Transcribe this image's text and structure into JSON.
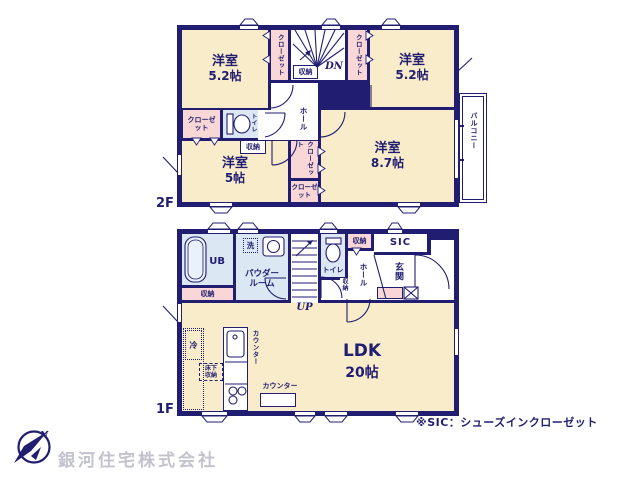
{
  "f2": {
    "label": "2F",
    "room_tl": "洋室",
    "room_tl_size": "5.2帖",
    "room_tr": "洋室",
    "room_tr_size": "5.2帖",
    "room_bl": "洋室",
    "room_bl_size": "5帖",
    "room_br": "洋室",
    "room_br_size": "8.7帖",
    "closet_left": "クローゼット",
    "closet_right": "クローゼット",
    "closet_wall": "クローゼット",
    "closet_mid": "クローゼット",
    "closet_mid2": "クローゼット",
    "toilet": "トイレ",
    "hall": "ホール",
    "storage_stairs": "収納",
    "storage_toilet": "収納",
    "dn": "DN",
    "balcony": "バルコニー"
  },
  "f1": {
    "label": "1F",
    "ub": "UB",
    "wash": "洗",
    "powder1": "パウダー",
    "powder2": "ルーム",
    "storage_ub": "収納",
    "up": "UP",
    "toilet": "トイレ",
    "storage_toilet": "収納",
    "storage_top": "収納",
    "sic": "SIC",
    "hall": "ホール",
    "genkan": "玄関",
    "ldk": "LDK",
    "ldk_size": "20帖",
    "fridge": "冷",
    "underfloor1": "床下",
    "underfloor2": "収納",
    "counter_kitchen": "カウンター",
    "counter_low": "カウンター"
  },
  "footer": {
    "note": "※SIC：シューズインクローゼット",
    "company": "銀河住宅株式会社",
    "compass_n": "N"
  },
  "colors": {
    "wall": "#211d70",
    "room": "#f8ecca",
    "closet": "#f8d7d6",
    "wet": "#dce7f4"
  }
}
